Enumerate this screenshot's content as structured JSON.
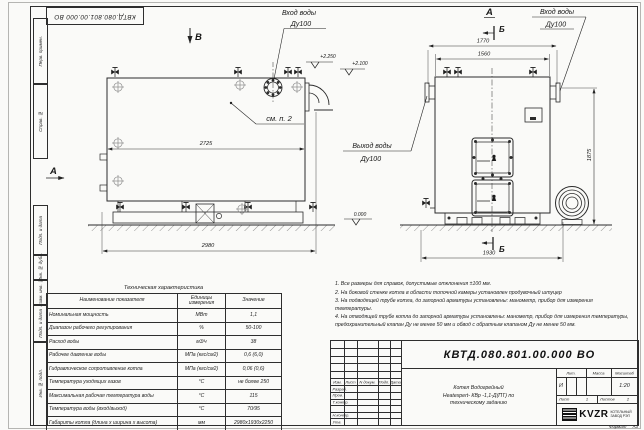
{
  "doc": {
    "number": "КВТД.080.801.00.000 ВО",
    "title_line1": "Котел Водогрейный",
    "title_line2": "Heatexpert- КВр -1,1-Д(ПТ) по",
    "title_line3": "техническому заданию",
    "lit": "И",
    "mass": "",
    "scale": "1:20",
    "sheet_label": "Лист",
    "sheet_num": "1",
    "sheets_label": "Листов",
    "sheets_num": "2",
    "format_label": "Формат",
    "format_value": "А3",
    "company_logo": "KVZR",
    "company_line1": "КОТЕЛЬНЫЙ",
    "company_line2": "ЗАВОД РЭП"
  },
  "title_block": {
    "col_izm": "Изм.",
    "col_list": "Лист",
    "col_doc": "N докум.",
    "col_sign": "Подп.",
    "col_date": "Дата",
    "row_razrab": "Разраб.",
    "row_prov": "Пров.",
    "row_tkontr": "Т.контр.",
    "row_nkontr": "Н.контр.",
    "row_utv": "Утв.",
    "lit_label": "Лит.",
    "mass_label": "Масса",
    "scale_label": "Масштаб"
  },
  "frame": {
    "left_labels": [
      "Перв. примен.",
      "Справ. №",
      "Подп. и дата",
      "Инв. № дубл.",
      "Взам. инв. №",
      "Подп. и дата",
      "Инв. № подл."
    ]
  },
  "labels": {
    "view_b": "В",
    "view_a": "А",
    "section_a": "А",
    "section_b": "Б",
    "inlet": "Вход воды",
    "outlet": "Выход воды",
    "dn": "Ду100",
    "see_note": "см. п. 2",
    "elev_2250": "+2.250",
    "elev_2100": "+2.100",
    "elev_0": "0.000"
  },
  "dims": {
    "d2725": "2725",
    "d2980": "2980",
    "d1770": "1770",
    "d1560": "1560",
    "d1875": "1875",
    "d1930": "1930"
  },
  "notes": [
    "1. Все размеры для справок, допустимые отклонения ±100 мм.",
    "2. На боковой стенке котла в области топочной камеры установлен продувочный штуцер",
    "3. На подводящей трубе котла, до запорной арматуры установлены: манометр, прибор для измерения температуры.",
    "4. На отводящей трубе котла до запорной арматуры установлены: манометр, прибор для измерения температуры, предохранительный клапан Ду не менее 50 мм и обвод с обратным клапаном Ду не менее 50 мм."
  ],
  "tech_table": {
    "title": "Техническая характеристика",
    "headers": [
      "Наименование показателя",
      "Единицы измерения",
      "Значение"
    ],
    "rows": [
      [
        "Номинальная мощность",
        "МВт",
        "1,1"
      ],
      [
        "Диапазон рабочего регулирования",
        "%",
        "50-100"
      ],
      [
        "Расход воды",
        "м3/ч",
        "38"
      ],
      [
        "Рабочее давление воды",
        "МПа (кгс/см2)",
        "0,6 (6,0)"
      ],
      [
        "Гидравлическое сопротивление котла",
        "МПа (кгс/см2)",
        "0,06 (0,6)"
      ],
      [
        "Температура уходящих газов",
        "°С",
        "не более 250"
      ],
      [
        "Максимальная рабочая температура воды",
        "°С",
        "115"
      ],
      [
        "Температура воды (вход/выход)",
        "°С",
        "70/95"
      ],
      [
        "Габариты котла (длина х ширина х высота)",
        "мм",
        "2980х1930х2250"
      ]
    ]
  }
}
